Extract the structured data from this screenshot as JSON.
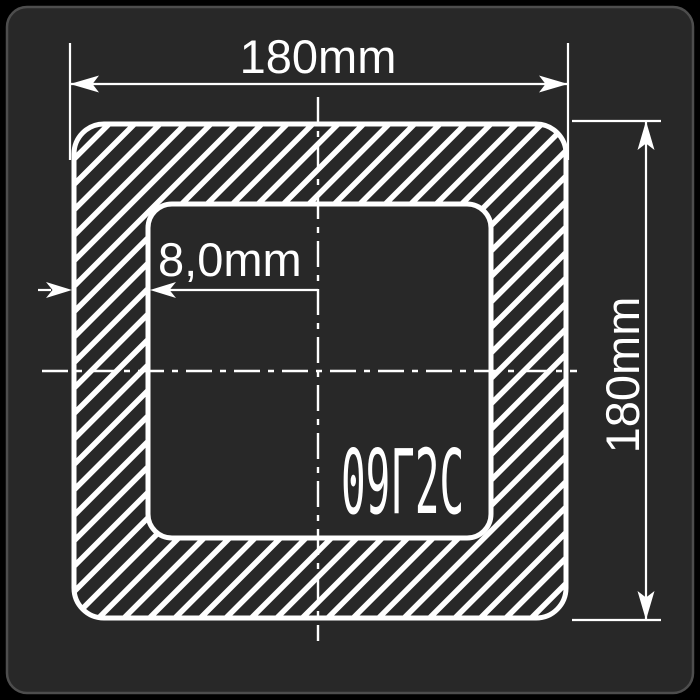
{
  "canvas": {
    "background_color": "#000000"
  },
  "panel": {
    "background_color": "#282828",
    "border_color": "#4d4d4d"
  },
  "diagram": {
    "kind": "technical cross-section drawing of a square hollow tube profile",
    "line_color": "#ffffff",
    "hatch_direction": "diagonal-45-bottomleft-to-topright",
    "labels": {
      "outer_width": "180mm",
      "outer_height": "180mm",
      "wall_thickness": "8,0mm",
      "steel_grade": "09Г2С"
    }
  }
}
